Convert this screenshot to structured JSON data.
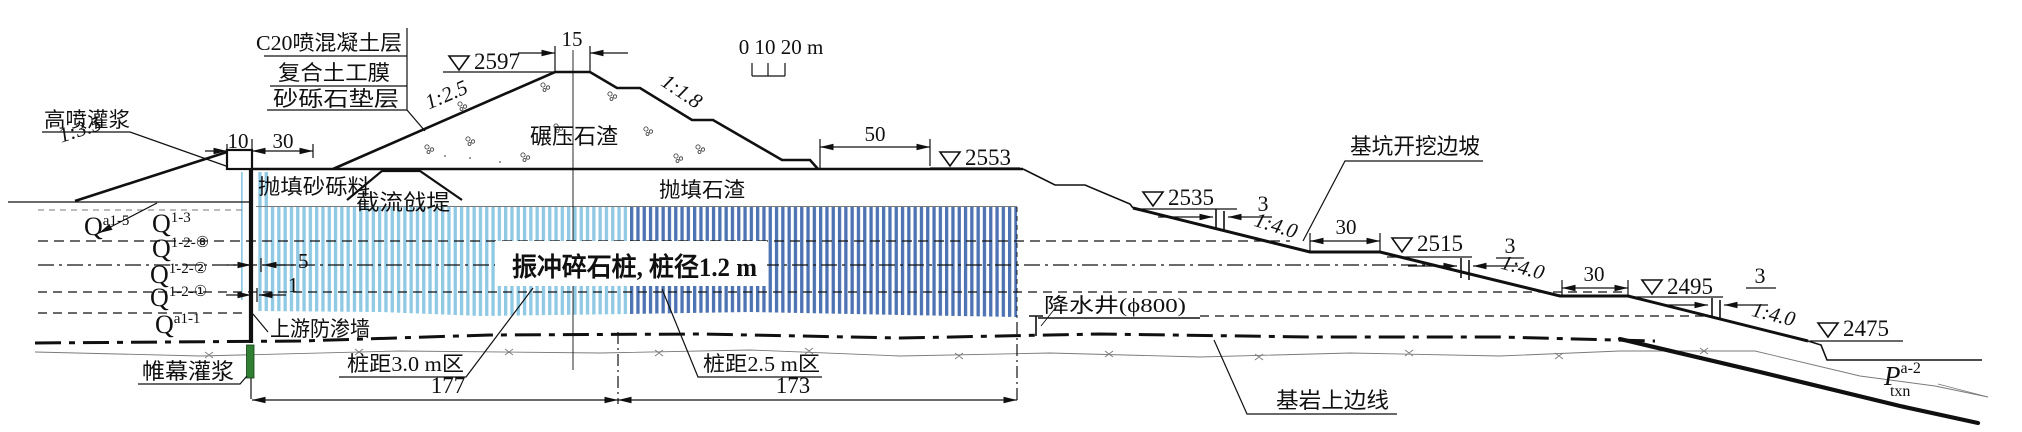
{
  "labels": {
    "materials": [
      "C20喷混凝土层",
      "复合土工膜",
      "砂砾石垫层"
    ],
    "jet_grouting": "高喷灌浆",
    "dumped_gravel_fill": "抛填砂砾料",
    "closure_dike": "截流戗堤",
    "rolled_rockfill": "碾压石渣",
    "dumped_rockfill": "抛填石渣",
    "stone_columns": "振冲碎石桩, 桩径1.2 m",
    "upstream_cutoff_wall": "上游防渗墙",
    "curtain_grouting": "帷幕灌浆",
    "zone_spacing_3m": "桩距3.0 m区",
    "zone_spacing_2_5m": "桩距2.5 m区",
    "dewatering_well": "降水井(ϕ800)",
    "pit_excavation_slope": "基坑开挖边坡",
    "bedrock_top_line": "基岩上边线"
  },
  "elevations": {
    "crest": "2597",
    "platform": "2553",
    "bench1": "2535",
    "bench2": "2515",
    "bench3": "2495",
    "pit_bottom": "2475"
  },
  "slopes": {
    "upstream_cofferdam": "1:3.5",
    "upstream_face": "1:2.5",
    "downstream_face": "1:1.8",
    "excavation": "1:4.0"
  },
  "dims": {
    "crest_width": "15",
    "cap_width": "10",
    "upper_berm": "30",
    "platform_width": "50",
    "wall_to_columns": "5",
    "row_offset": "1",
    "zone3_length": "177",
    "zone25_length": "173",
    "bench_width": "30",
    "step_width": "3"
  },
  "scale_bar": "0 10 20 m",
  "strata": [
    {
      "base": "Q",
      "sup": "a1-5"
    },
    {
      "base": "Q",
      "sup": "1-3"
    },
    {
      "base": "Q",
      "sup": "1-2-⑧"
    },
    {
      "base": "Q",
      "sup": "1-2-②"
    },
    {
      "base": "Q",
      "sup": "1-2-①"
    },
    {
      "base": "Q",
      "sup": "a1-1"
    }
  ],
  "formation": {
    "base": "P",
    "sup": "a-2",
    "sub": "txn"
  },
  "colors": {
    "zone3_fill": "#8FC9E4",
    "zone25_fill": "#4E73B3",
    "curtain_grouting": "#2F8032",
    "fault_line": "#ED7D31"
  }
}
